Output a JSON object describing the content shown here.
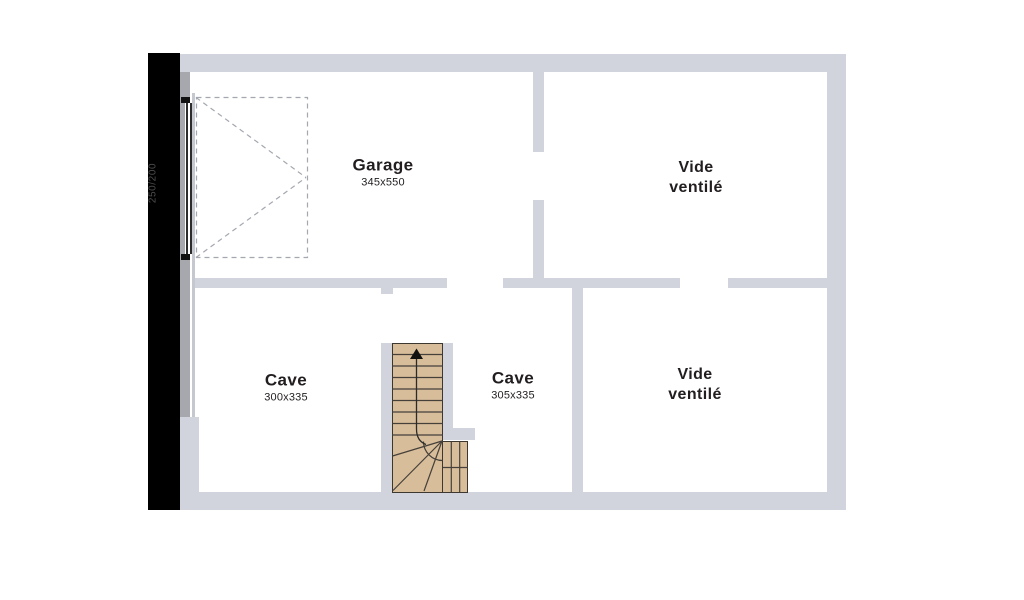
{
  "rooms": {
    "garage": {
      "name": "Garage",
      "dims": "345x550"
    },
    "vide_top": {
      "lines": [
        "Vide",
        "ventilé"
      ]
    },
    "cave_left": {
      "name": "Cave",
      "dims": "300x335"
    },
    "cave_right": {
      "name": "Cave",
      "dims": "305x335"
    },
    "vide_bottom": {
      "lines": [
        "Vide",
        "ventilé"
      ]
    }
  },
  "garage_door": {
    "dimension_label": "250/200"
  },
  "colors": {
    "wall": "#d2d4dd",
    "wall_dark": "#a6a8ad",
    "stair_fill": "#d8bd9a",
    "stair_line": "#45403a",
    "black_strip": "#000000",
    "text": "#221e20",
    "dashed_swing": "#a3a7af"
  }
}
